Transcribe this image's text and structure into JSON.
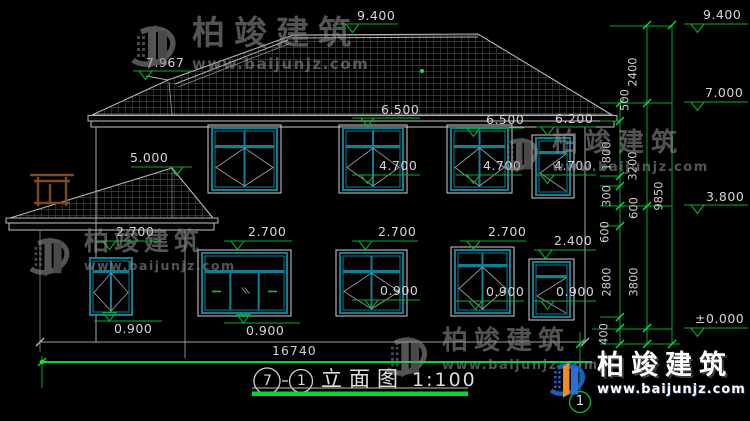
{
  "watermark": {
    "brand": "柏竣建筑",
    "url": "www.baijunjz.com"
  },
  "logo": {
    "brand": "柏竣建筑",
    "url": "www.baijunjz.com"
  },
  "title_block": {
    "axis_from": "7",
    "axis_to": "1",
    "name": "立面图",
    "scale": "1:100"
  },
  "axis_bubble": "1",
  "h_dim": {
    "text": "16740",
    "x": 272,
    "y": 345
  },
  "elevations": [
    {
      "text": "7.967",
      "x": 146,
      "y": 57,
      "lx1": 133,
      "lx2": 192,
      "ly": 71,
      "tx": 139,
      "above": false
    },
    {
      "text": "9.400",
      "x": 357,
      "y": 10,
      "lx1": 336,
      "lx2": 398,
      "ly": 24,
      "tx": 346,
      "above": false
    },
    {
      "text": "9.400",
      "x": 703,
      "y": 9,
      "lx1": 684,
      "lx2": 748,
      "ly": 24,
      "tx": 691,
      "above": false
    },
    {
      "text": "7.000",
      "x": 705,
      "y": 87,
      "lx1": 684,
      "lx2": 748,
      "ly": 102,
      "tx": 691,
      "above": false
    },
    {
      "text": "3.800",
      "x": 706,
      "y": 191,
      "lx1": 684,
      "lx2": 748,
      "ly": 205,
      "tx": 691,
      "above": false
    },
    {
      "text": "±0.000",
      "x": 695,
      "y": 313,
      "lx1": 684,
      "lx2": 748,
      "ly": 328,
      "tx": 691,
      "above": false
    },
    {
      "text": "5.000",
      "x": 130,
      "y": 152,
      "lx1": 131,
      "lx2": 192,
      "ly": 167,
      "tx": 170,
      "above": false
    },
    {
      "text": "6.500",
      "x": 381,
      "y": 104,
      "lx1": 352,
      "lx2": 420,
      "ly": 118,
      "tx": 361,
      "above": false
    },
    {
      "text": "6.500",
      "x": 486,
      "y": 114,
      "lx1": 456,
      "lx2": 524,
      "ly": 128,
      "tx": 467,
      "above": false
    },
    {
      "text": "6.200",
      "x": 555,
      "y": 113,
      "lx1": 536,
      "lx2": 596,
      "ly": 127,
      "tx": 541,
      "above": false
    },
    {
      "text": "4.700",
      "x": 379,
      "y": 160,
      "lx1": 352,
      "lx2": 420,
      "ly": 175,
      "tx": 361,
      "above": false
    },
    {
      "text": "4.700",
      "x": 483,
      "y": 160,
      "lx1": 456,
      "lx2": 522,
      "ly": 175,
      "tx": 467,
      "above": false
    },
    {
      "text": "4.700",
      "x": 554,
      "y": 160,
      "lx1": 536,
      "lx2": 596,
      "ly": 175,
      "tx": 541,
      "above": false
    },
    {
      "text": "2.700",
      "x": 116,
      "y": 226,
      "lx1": 96,
      "lx2": 162,
      "ly": 241,
      "tx": 103,
      "above": false
    },
    {
      "text": "2.700",
      "x": 248,
      "y": 226,
      "lx1": 224,
      "lx2": 292,
      "ly": 241,
      "tx": 231,
      "above": false
    },
    {
      "text": "2.700",
      "x": 378,
      "y": 226,
      "lx1": 352,
      "lx2": 418,
      "ly": 241,
      "tx": 359,
      "above": false
    },
    {
      "text": "2.700",
      "x": 488,
      "y": 226,
      "lx1": 460,
      "lx2": 526,
      "ly": 241,
      "tx": 467,
      "above": false
    },
    {
      "text": "2.400",
      "x": 554,
      "y": 235,
      "lx1": 534,
      "lx2": 596,
      "ly": 250,
      "tx": 539,
      "above": false
    },
    {
      "text": "0.900",
      "x": 114,
      "y": 323,
      "lx1": 94,
      "lx2": 162,
      "ly": 321,
      "tx": 103,
      "above": true
    },
    {
      "text": "0.900",
      "x": 246,
      "y": 325,
      "lx1": 224,
      "lx2": 300,
      "ly": 323,
      "tx": 237,
      "above": true
    },
    {
      "text": "0.900",
      "x": 380,
      "y": 285,
      "lx1": 352,
      "lx2": 420,
      "ly": 300,
      "tx": 365,
      "above": false
    },
    {
      "text": "0.900",
      "x": 486,
      "y": 286,
      "lx1": 456,
      "lx2": 524,
      "ly": 301,
      "tx": 469,
      "above": false
    },
    {
      "text": "0.900",
      "x": 556,
      "y": 286,
      "lx1": 534,
      "lx2": 596,
      "ly": 301,
      "tx": 541,
      "above": false
    }
  ],
  "v_dims": [
    {
      "text": "2400",
      "x": 633,
      "y": 72
    },
    {
      "text": "500",
      "x": 625,
      "y": 100
    },
    {
      "text": "1800",
      "x": 607,
      "y": 156
    },
    {
      "text": "3200",
      "x": 633,
      "y": 166
    },
    {
      "text": "300",
      "x": 607,
      "y": 196
    },
    {
      "text": "600",
      "x": 634,
      "y": 208
    },
    {
      "text": "600",
      "x": 605,
      "y": 232
    },
    {
      "text": "9850",
      "x": 659,
      "y": 196
    },
    {
      "text": "2800",
      "x": 607,
      "y": 282
    },
    {
      "text": "3800",
      "x": 634,
      "y": 282
    },
    {
      "text": "400",
      "x": 604,
      "y": 334
    }
  ]
}
